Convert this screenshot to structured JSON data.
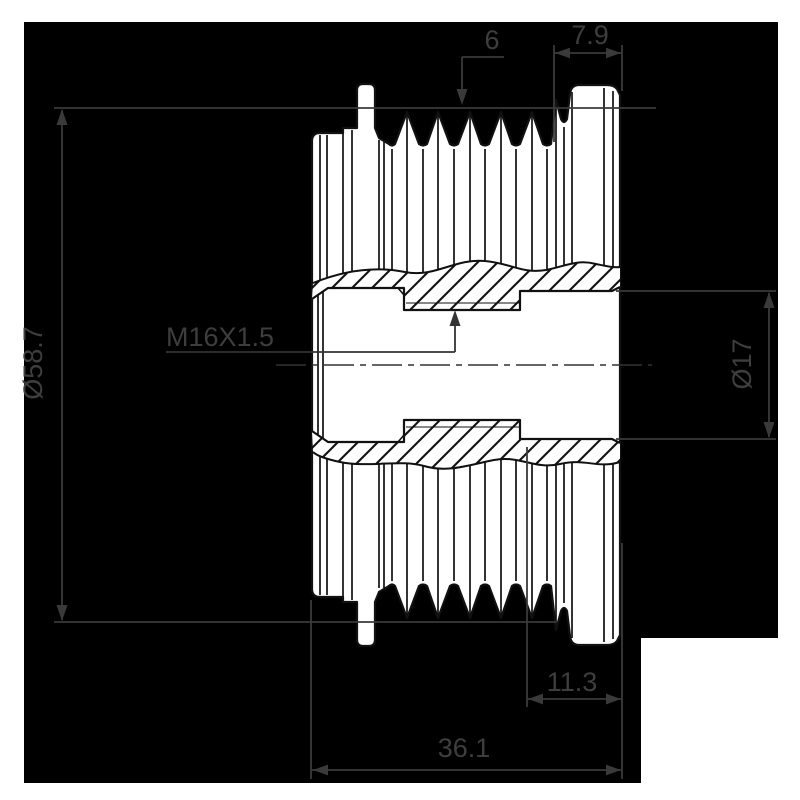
{
  "page": {
    "background_color": "#ffffff",
    "canvas_color": "#000000"
  },
  "drawing": {
    "style": {
      "part_fill": "#ffffff",
      "part_line_color": "#111111",
      "dimension_color": "#3e3e3e",
      "centerline_color": "#333333"
    },
    "dimensions": {
      "groove_count": {
        "label": "6"
      },
      "right_flange_width": {
        "label": "7.9"
      },
      "outer_diameter": {
        "label": "Ø58.7"
      },
      "thread_spec": {
        "label": "M16X1.5"
      },
      "bore_diameter": {
        "label": "Ø17"
      },
      "bore_depth": {
        "label": "11.3"
      },
      "overall_width": {
        "label": "36.1"
      }
    }
  }
}
